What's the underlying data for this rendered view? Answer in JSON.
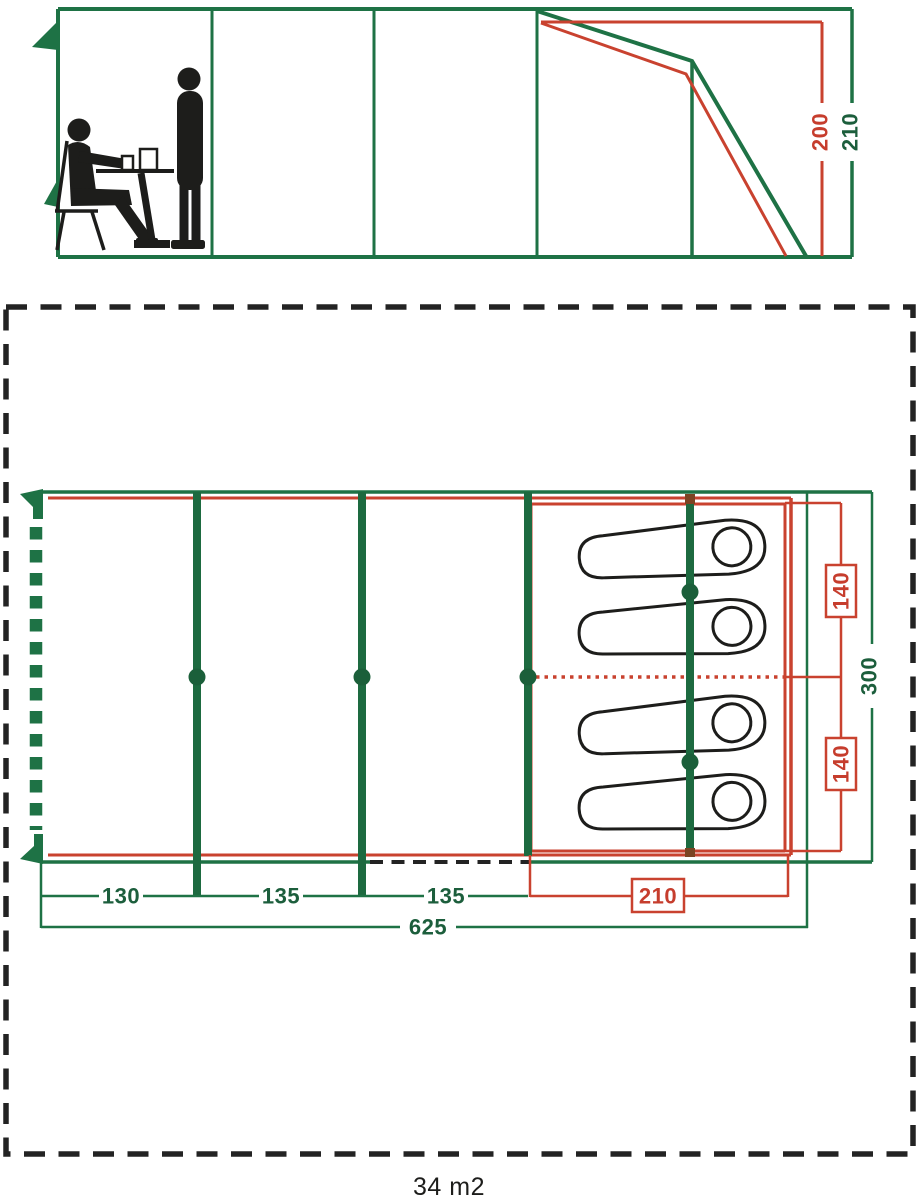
{
  "diagram": {
    "kind": "tent dimension diagram",
    "area": "34 m2"
  },
  "colors": {
    "green": "#1e7245",
    "pole_green": "#1d6a40",
    "red": "#c9422f",
    "outline_black": "#1d1d1b",
    "dash_border": "#232323"
  },
  "side_view": {
    "inner_height": "200",
    "outer_height": "210"
  },
  "floor_plan": {
    "section_widths": [
      "130",
      "135",
      "135"
    ],
    "bedroom_width": "210",
    "total_width": "625",
    "bedroom_depths": [
      "140",
      "140"
    ],
    "total_depth": "300"
  },
  "icons": {
    "seated_person": "seated-person-pictogram",
    "standing_person": "standing-person-pictogram",
    "sleeping_bag": "sleeping-bag-outline",
    "corner_flag": "green-pennant",
    "pole_joint": "green-dot"
  }
}
